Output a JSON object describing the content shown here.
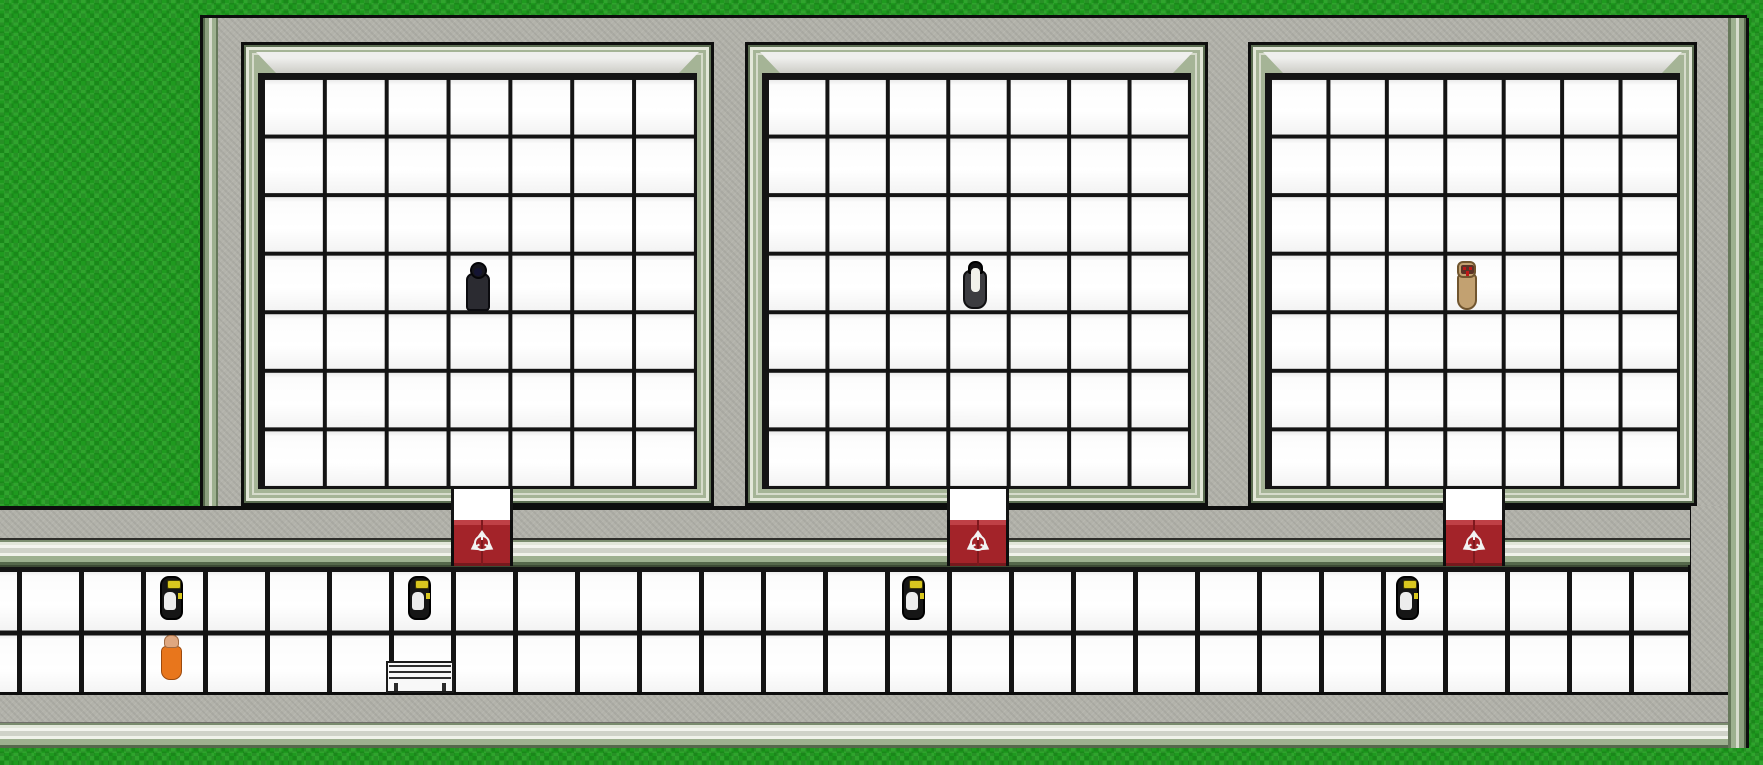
{
  "scene": {
    "kind": "top-down-facility-game",
    "description": "SCP-style containment wing: three white-tiled cells with red containment doors opening onto a tiled corridor, surrounded by concrete walls and grass"
  },
  "colors": {
    "grass": "#1f9a1f",
    "concrete": "#b2b2aa",
    "trim-sage": "#a5b496",
    "bevel": "#cdcdc7",
    "tile": "#ffffff",
    "grid-line": "#141414",
    "door-red": "#a32329",
    "door-red-top": "#bf4046",
    "door-seam": "#7e181d",
    "logo": "#f2f2f2",
    "guard-body": "#161616",
    "guard-visor": "#d9c71f",
    "guard-vest": "#ededed",
    "classd-orange": "#e8761c",
    "classd-skin": "#dfa77f",
    "scp049-robe": "#2b2b31",
    "scp049-hood": "#17171d",
    "scp049-face": "#141432",
    "scp096-body": "#3c3c40",
    "scp096-hair": "#121214",
    "scp096-face": "#f1f1ea",
    "scp173-body": "#c2a171",
    "scp173-face": "#5a3326",
    "scp173-eye": "#c01818"
  },
  "layout": {
    "canvas": {
      "x": 0,
      "y": 0,
      "w": 1763,
      "h": 765
    },
    "building": {
      "x": 200,
      "y": 15,
      "w": 1547,
      "h": 491
    },
    "left_edge_trim": {
      "x": 200,
      "y": 18,
      "w": 18,
      "h": 488
    },
    "right_edge_trim": {
      "x": 1728,
      "y": 18,
      "w": 21,
      "h": 730
    },
    "right_wall_lower": {
      "x": 1688,
      "y": 506,
      "w": 59,
      "h": 242
    },
    "corridor_top_wall": {
      "x": 0,
      "y": 506,
      "w": 1690,
      "h": 59
    },
    "corridor_tiles": {
      "x": 0,
      "y": 565,
      "w": 1688,
      "h": 127
    },
    "corridor_bottom_wall": {
      "x": 0,
      "y": 692,
      "w": 1747,
      "h": 56
    }
  },
  "rooms": [
    {
      "name": "containment-cell-1",
      "occupant": "scp-049-dark-robed-figure",
      "box": {
        "x": 241,
        "y": 42,
        "w": 473,
        "h": 464
      },
      "door": {
        "x": 451,
        "y": 520,
        "w": 62,
        "h": 46
      },
      "door_gap": {
        "x": 451,
        "y": 489,
        "w": 62,
        "h": 31
      },
      "grid": {
        "cols": 7,
        "rows": 7
      }
    },
    {
      "name": "containment-cell-2",
      "occupant": "scp-096-pale-faced-figure",
      "box": {
        "x": 745,
        "y": 42,
        "w": 463,
        "h": 464
      },
      "door": {
        "x": 947,
        "y": 520,
        "w": 62,
        "h": 46
      },
      "door_gap": {
        "x": 947,
        "y": 489,
        "w": 62,
        "h": 31
      },
      "grid": {
        "cols": 7,
        "rows": 7
      }
    },
    {
      "name": "containment-cell-3",
      "occupant": "scp-173-statue",
      "box": {
        "x": 1248,
        "y": 42,
        "w": 449,
        "h": 464
      },
      "door": {
        "x": 1443,
        "y": 520,
        "w": 62,
        "h": 46
      },
      "door_gap": {
        "x": 1443,
        "y": 489,
        "w": 62,
        "h": 31
      },
      "grid": {
        "cols": 7,
        "rows": 7
      }
    }
  ],
  "characters": [
    {
      "kind": "scp-049-dark-robed-figure",
      "location": "cell-1-center",
      "pos": {
        "x": 462,
        "y": 262,
        "w": 32,
        "h": 50
      }
    },
    {
      "kind": "scp-096-pale-faced-figure",
      "location": "cell-2-center",
      "pos": {
        "x": 959,
        "y": 261,
        "w": 32,
        "h": 50
      }
    },
    {
      "kind": "scp-173-statue",
      "location": "cell-3-center",
      "pos": {
        "x": 1452,
        "y": 261,
        "w": 30,
        "h": 50
      }
    },
    {
      "kind": "guard-facing-north",
      "location": "corridor-row-1",
      "pos": {
        "x": 158,
        "y": 575,
        "w": 27,
        "h": 46
      }
    },
    {
      "kind": "guard-facing-north",
      "location": "corridor-row-1-left-of-door-1",
      "pos": {
        "x": 406,
        "y": 575,
        "w": 27,
        "h": 46
      }
    },
    {
      "kind": "guard-facing-north",
      "location": "corridor-row-1-left-of-door-2",
      "pos": {
        "x": 900,
        "y": 575,
        "w": 27,
        "h": 46
      }
    },
    {
      "kind": "guard-facing-north",
      "location": "corridor-row-1-left-of-door-3",
      "pos": {
        "x": 1394,
        "y": 575,
        "w": 27,
        "h": 46
      }
    },
    {
      "kind": "class-d-orange-jumpsuit",
      "location": "corridor-row-2",
      "pos": {
        "x": 158,
        "y": 634,
        "w": 27,
        "h": 47
      }
    }
  ],
  "props": [
    {
      "kind": "bench",
      "location": "corridor-row-2",
      "pos": {
        "x": 386,
        "y": 661,
        "w": 68,
        "h": 32
      }
    }
  ]
}
